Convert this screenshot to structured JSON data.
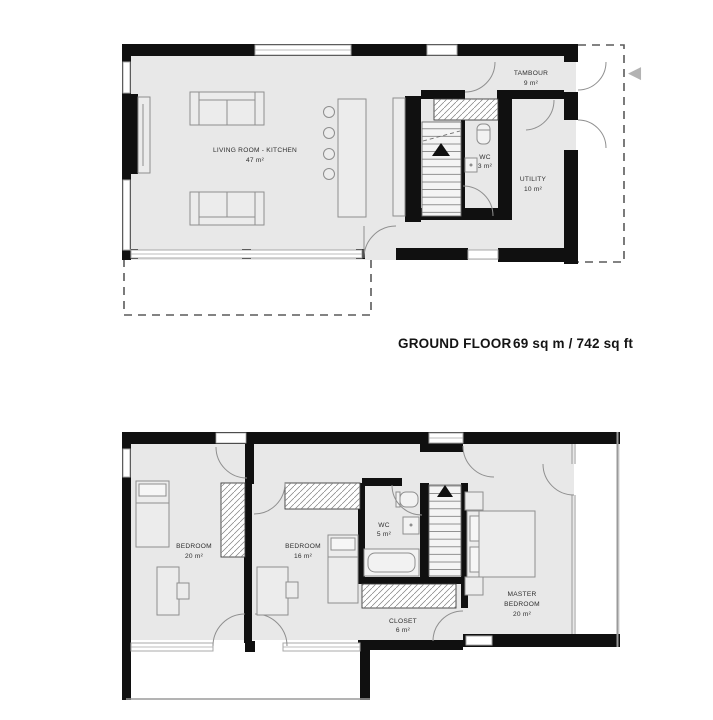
{
  "colors": {
    "wall": "#101010",
    "floor": "#e8e8e8",
    "door_line": "#8f8f8f",
    "furniture_line": "#8e8e8e",
    "glazing_line": "#a8a8a8",
    "dashed_line": "#5a5a5a",
    "arrow": "#b3b3b3"
  },
  "ground_floor": {
    "caption_title": "GROUND FLOOR",
    "caption_area": "69 sq m / 742 sq ft",
    "rooms": {
      "living_kitchen": {
        "name": "LIVING ROOM - KITCHEN",
        "area": "47 m²"
      },
      "tambour": {
        "name": "TAMBOUR",
        "area": "9 m²"
      },
      "wc": {
        "name": "WC",
        "area": "3 m²"
      },
      "utility": {
        "name": "UTILITY",
        "area": "10 m²"
      }
    }
  },
  "first_floor": {
    "rooms": {
      "bedroom1": {
        "name": "BEDROOM",
        "area": "20 m²"
      },
      "bedroom2": {
        "name": "BEDROOM",
        "area": "16 m²"
      },
      "wc": {
        "name": "WC",
        "area": "5 m²"
      },
      "closet": {
        "name": "CLOSET",
        "area": "6 m²"
      },
      "master": {
        "name_line1": "MASTER",
        "name_line2": "BEDROOM",
        "area": "20 m²"
      }
    }
  },
  "carousel": {
    "prev_icon": "◀"
  }
}
